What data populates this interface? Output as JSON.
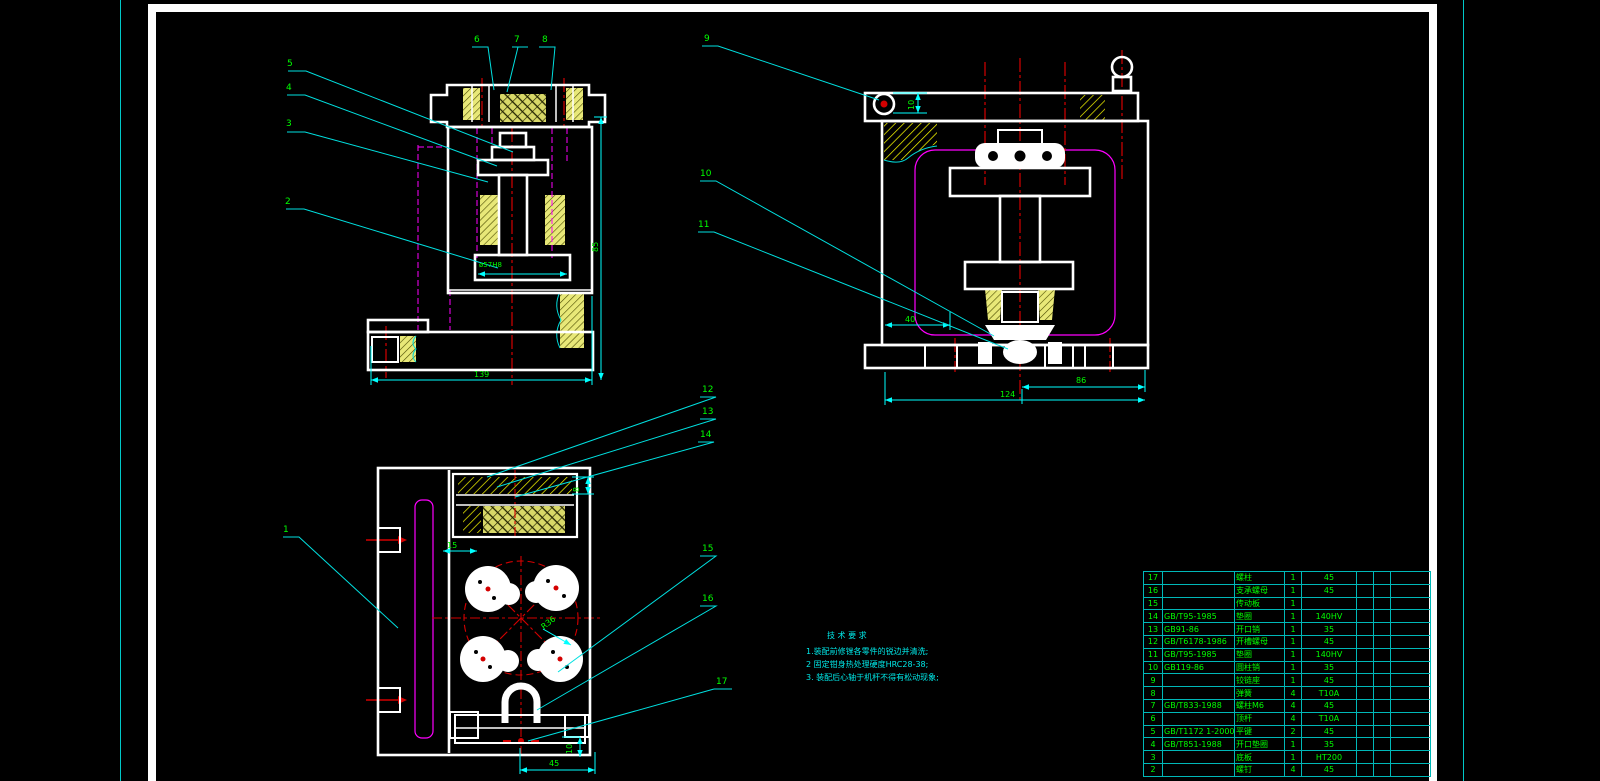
{
  "colors": {
    "background": "#000000",
    "outline_white": "#ffffff",
    "dimension_cyan": "#00ffff",
    "text_green": "#00ff00",
    "centerline_red": "#d40000",
    "hidden_magenta": "#ff00ff",
    "hatch_yellow": "#ffff00",
    "table_grid_cyan": "#00b8b8"
  },
  "part_labels": {
    "n1": "1",
    "n2": "2",
    "n3": "3",
    "n4": "4",
    "n5": "5",
    "n6": "6",
    "n7": "7",
    "n8": "8",
    "n9": "9",
    "n10": "10",
    "n11": "11",
    "n12": "12",
    "n13": "13",
    "n14": "14",
    "n15": "15",
    "n16": "16",
    "n17": "17"
  },
  "dimensions": {
    "v1_width": "139",
    "v1_bore": "ø57H8",
    "v1_height": "85",
    "v2_top": "10",
    "v2_offset": "40",
    "v2_right": "86",
    "v2_total": "124",
    "v3_slot": "15",
    "v3_gib": "8",
    "v3_radius": "R36",
    "v3_key": "10",
    "v3_width": "45"
  },
  "notes": {
    "title": "技 术 要 求",
    "lines": [
      "1.装配前修锉各零件的锐边并清洗;",
      "2 固定钳身热处理硬度HRC28-38;",
      "3. 装配后心轴于机杆不得有松动现象;"
    ]
  },
  "bom": {
    "rows": [
      {
        "no": "17",
        "code": "",
        "name": "螺柱",
        "qty": "1",
        "material": "45"
      },
      {
        "no": "16",
        "code": "",
        "name": "支承螺母",
        "qty": "1",
        "material": "45"
      },
      {
        "no": "15",
        "code": "",
        "name": "传动板",
        "qty": "1",
        "material": ""
      },
      {
        "no": "14",
        "code": "GB/T95-1985",
        "name": "垫圈",
        "qty": "1",
        "material": "140HV"
      },
      {
        "no": "13",
        "code": "GB91-86",
        "name": "开口销",
        "qty": "1",
        "material": "35"
      },
      {
        "no": "12",
        "code": "GB/T6178-1986",
        "name": "开槽螺母",
        "qty": "1",
        "material": "45"
      },
      {
        "no": "11",
        "code": "GB/T95-1985",
        "name": "垫圈",
        "qty": "1",
        "material": "140HV"
      },
      {
        "no": "10",
        "code": "GB119-86",
        "name": "圆柱销",
        "qty": "1",
        "material": "35"
      },
      {
        "no": "9",
        "code": "",
        "name": "铰链座",
        "qty": "1",
        "material": "45"
      },
      {
        "no": "8",
        "code": "",
        "name": "弹簧",
        "qty": "4",
        "material": "T10A"
      },
      {
        "no": "7",
        "code": "GB/T833-1988",
        "name": "螺柱M6",
        "qty": "4",
        "material": "45"
      },
      {
        "no": "6",
        "code": "",
        "name": "顶杆",
        "qty": "4",
        "material": "T10A"
      },
      {
        "no": "5",
        "code": "GB/T1172 1-2000",
        "name": "平键",
        "qty": "2",
        "material": "45"
      },
      {
        "no": "4",
        "code": "GB/T851-1988",
        "name": "开口垫圈",
        "qty": "1",
        "material": "35"
      },
      {
        "no": "3",
        "code": "",
        "name": "底板",
        "qty": "1",
        "material": "HT200"
      },
      {
        "no": "2",
        "code": "",
        "name": "螺钉",
        "qty": "4",
        "material": "45"
      }
    ]
  }
}
